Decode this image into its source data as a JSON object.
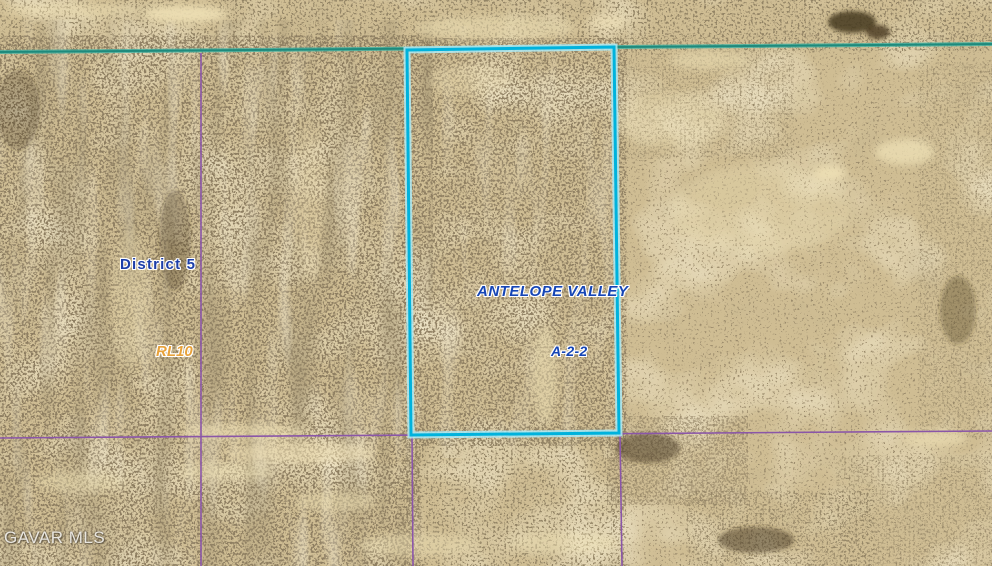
{
  "map": {
    "type": "satellite-parcel-map",
    "labels": {
      "district": {
        "text": "District 5",
        "color": "#1c3ea8"
      },
      "area_name": {
        "text": "ANTELOPE VALLEY",
        "color": "#1545b5"
      },
      "zoning": {
        "text": "A-2-2",
        "color": "#1545b5"
      },
      "land_use": {
        "text": "RL10",
        "color": "#e8a23a"
      }
    },
    "watermark": {
      "text": "GAVAR MLS",
      "color": "#f3f1ec"
    },
    "colors": {
      "parcel_highlight": "#00b2dc",
      "parcel_highlight_halo": "#aeeaf5",
      "parcel_line": "#8a56a8",
      "section_line": "#1e8a7c",
      "section_line_halo": "#45b3a4"
    }
  }
}
